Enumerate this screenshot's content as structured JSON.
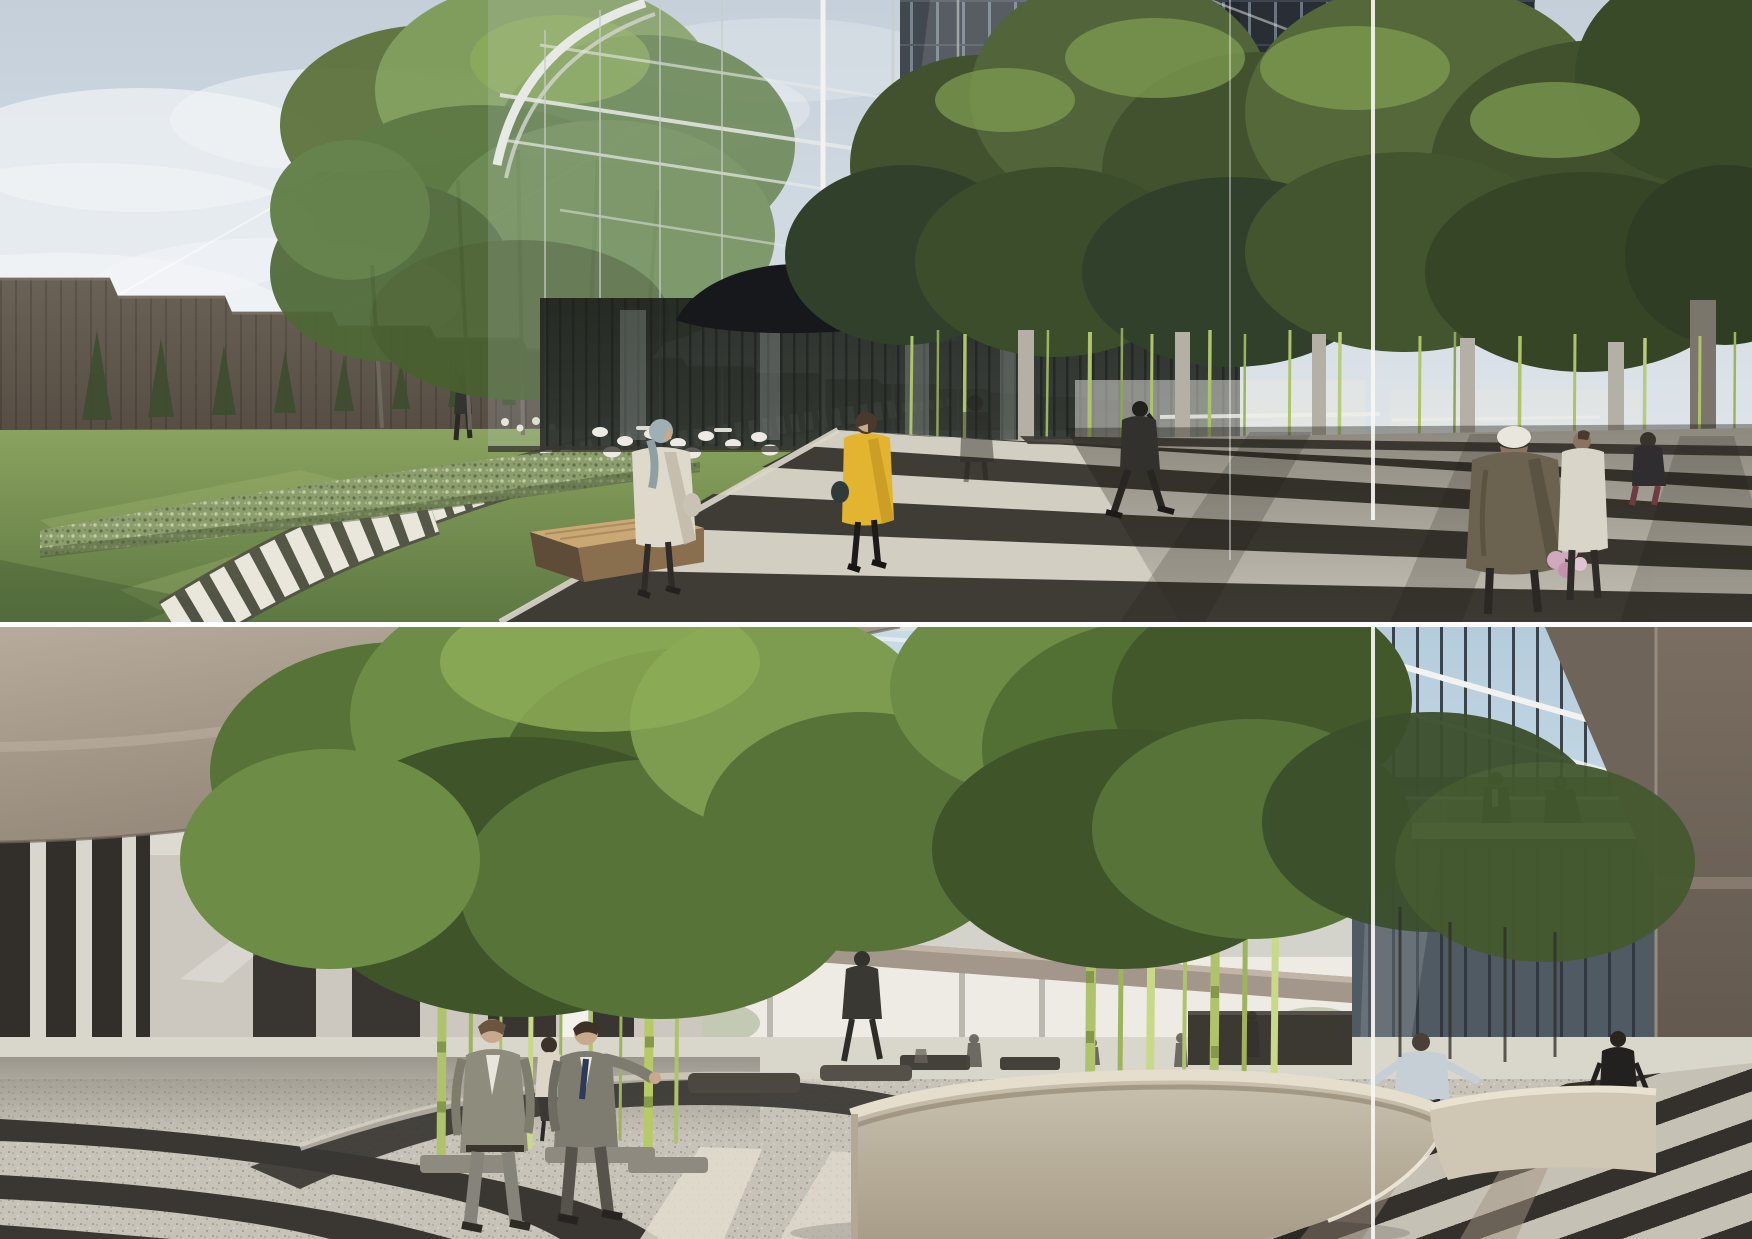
{
  "artwork": {
    "kind": "architectural-rendering-collage",
    "panel_count": 2,
    "panels": [
      {
        "id": "exterior-plaza",
        "label": "exterior plaza with glass atrium, striped paving, lawn path and bamboo court"
      },
      {
        "id": "interior-atrium",
        "label": "interior lobby atrium with bamboo grove, curved striped floor and oval reception desk"
      }
    ]
  },
  "palette": {
    "sky_top": "#c4cfda",
    "sky_low": "#e9edf0",
    "cloud": "#f1f4f6",
    "bldg_dark": "#564e44",
    "bldg_cap": "#7d7468",
    "cypress": "#3e4d2f",
    "hedge_base": "#8d9e6e",
    "hedge_dot_dark": "#5f714a",
    "hedge_dot_light": "#c2cda1",
    "shrub_dark": "#5a6f44",
    "lawn_light": "#8ba35f",
    "lawn_dark": "#5d7842",
    "path_plank": "#e9e6db",
    "path_gap": "#4f4c44",
    "curb": "#dcd7cb",
    "stripe_light_top": "#d3cec2",
    "stripe_dark_top": "#3f3b35",
    "facade_frame": "#e7e9e5",
    "glass_tint": "#ccd7dc",
    "tower_dark": "#242930",
    "tower_mullion": "#6e7a84",
    "canopy_black": "#17181b",
    "interior_dark": "#2f342f",
    "furniture_white": "#eceae2",
    "bamboo_dark": "#42522e",
    "bamboo_mid": "#5a7038",
    "bamboo_light": "#7e9c50",
    "bamboo_cane": "#afc36c",
    "bamboo_cane_bright": "#c8d98a",
    "pillar": "#b5b0a6",
    "planter_dark": "#2d2b27",
    "coat_cream": "#dfd9cb",
    "scarf_teal": "#9fb0b4",
    "coat_yellow": "#e2b42f",
    "hair_dark": "#4a392d",
    "skin": "#c9a88b",
    "suit_dark": "#33312d",
    "coat_parka": "#6c6250",
    "hat_white": "#e9e6de",
    "coat_white": "#dad5c9",
    "flowers_pink": "#d1a9bf",
    "white_line": "#f6f6f2",
    "ceil_light": "#b7ab9b",
    "ceil_dark": "#897e6f",
    "fascia": "#a2978a",
    "sky_glass_top": "#b4ccdc",
    "sky_glass_low": "#dce7ed",
    "strut_white": "#f3f4f1",
    "glasswall": "#49525b",
    "glass_mullion": "#2d343c",
    "mezz_slab": "#e8e5dd",
    "mezz_glass": "#b7c3c9",
    "vol_brown": "#7a6e62",
    "vol_base": "#453f38",
    "wall_light": "#ccc8bf",
    "wall_panel_dark": "#393631",
    "col_dark": "#322f2a",
    "slit_white": "#f2f1ea",
    "back_bright": "#edebe3",
    "floor_far": "#d9d6cc",
    "floor_shadow": "#8e8a81",
    "arc_dark": "#3a3733",
    "terrazzo": "#c7c3b8",
    "stripe_dark_bot": "#34312c",
    "stripe_light_bot": "#c6c1b5",
    "sun_patch": "#e3ddcf",
    "shadow_tan": "#a39482",
    "desk_top": "#e5decd",
    "desk_front": "#c9c1ae",
    "desk_shadow": "#a89d89",
    "planter_soil": "#3f3c35",
    "suit_a": "#8e8c7c",
    "suit_b": "#7e7c71",
    "shirt_white": "#e8e5dd",
    "tie_navy": "#2c3a58",
    "recep_shirt": "#c6ced6",
    "dress_dark": "#232120"
  },
  "people": {
    "top": [
      {
        "id": "man-on-garden-path",
        "desc": "distant man in dark suit on plank path"
      },
      {
        "id": "woman-headscarf",
        "desc": "woman in cream coat and grey-teal headscarf walking right"
      },
      {
        "id": "woman-yellow-coat",
        "desc": "woman in yellow coat with dark tights and handbag"
      },
      {
        "id": "ghost-figure-glass",
        "desc": "faint figure behind glazing"
      },
      {
        "id": "man-phone",
        "desc": "man in dark suit on phone crossing striped paving"
      },
      {
        "id": "woman-parka",
        "desc": "woman in olive parka with white bucket hat holding flowers"
      },
      {
        "id": "person-white-coat",
        "desc": "person in long white coat"
      },
      {
        "id": "woman-seated-bench",
        "desc": "woman seated on dark bench"
      }
    ],
    "bottom": [
      {
        "id": "businessman-left",
        "desc": "man in grey-green suit with open jacket walking forward"
      },
      {
        "id": "businessman-right",
        "desc": "man in grey suit and navy tie gesturing with raised arm"
      },
      {
        "id": "woman-behind-pair",
        "desc": "small woman in cream top behind the two men"
      },
      {
        "id": "background-walker",
        "desc": "man in dark suit walking on far floor"
      },
      {
        "id": "receptionist",
        "desc": "receptionist in pale blue shirt with arms spread at oval desk"
      },
      {
        "id": "woman-dark-dress",
        "desc": "woman in dark dress walking in right corridor"
      },
      {
        "id": "mezzanine-men",
        "desc": "two businessmen talking on mezzanine bridge"
      },
      {
        "id": "distant-silhouettes",
        "desc": "small distant figures near bright back wall"
      }
    ]
  }
}
